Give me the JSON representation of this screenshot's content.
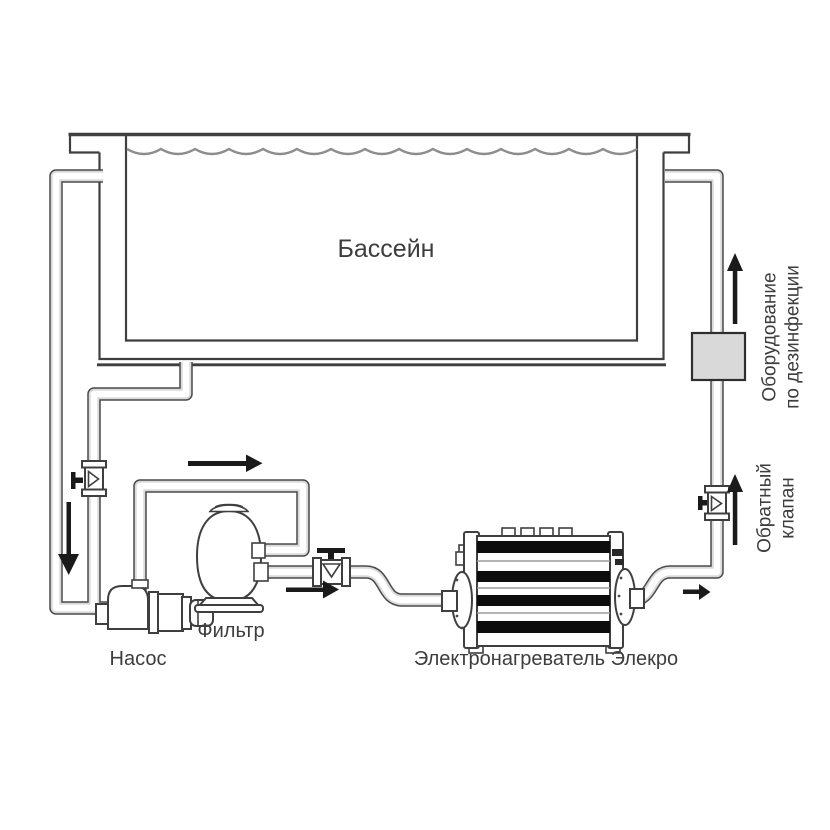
{
  "diagram": {
    "labels": {
      "pool": "Бассейн",
      "pump": "Насос",
      "filter": "Фильтр",
      "heater": "Электронагреватель Элекро",
      "disinfection_line1": "Оборудование",
      "disinfection_line2": "по дезинфекции",
      "check_valve_line1": "Обратный",
      "check_valve_line2": "клапан"
    },
    "colors": {
      "line": "#3f3f3f",
      "pipe_outline": "#4a4a4a",
      "arrow": "#1a1a1a",
      "wave": "#8c8c8c",
      "text": "#3d3d3d",
      "equipment_box_fill": "#d9d9d9",
      "heater_band": "#0d0d0d",
      "background": "#ffffff"
    }
  }
}
